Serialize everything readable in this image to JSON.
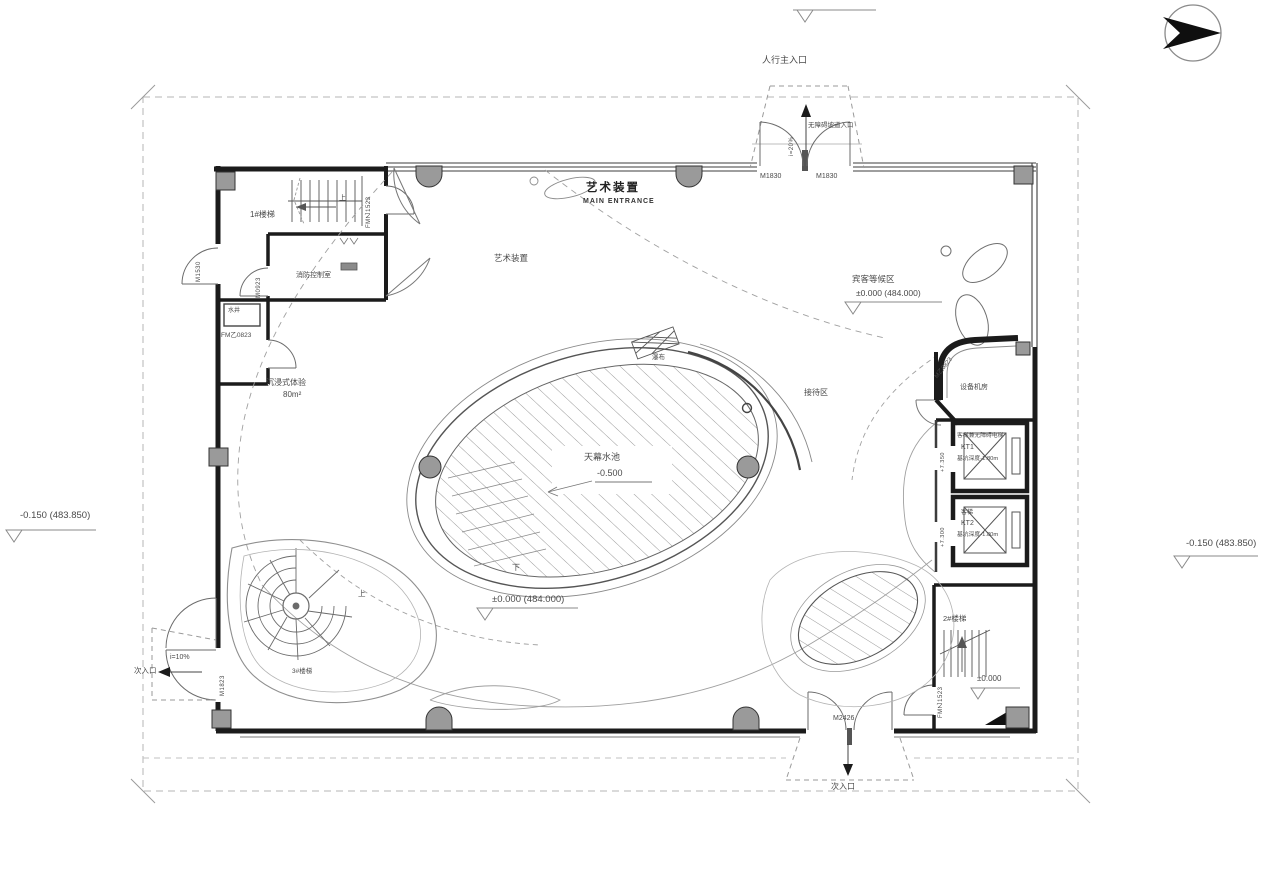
{
  "colors": {
    "wall": "#1b1b1b",
    "line_dark": "#3f3f3f",
    "line_mid": "#7a7a7a",
    "line_light": "#a9a9a9",
    "column_fill": "#9a9a9a",
    "text": "#4a4a4a"
  },
  "site": {
    "elev_left": "-0.150 (483.850)",
    "elev_right": "-0.150 (483.850)",
    "elev_floor": "±0.000 (484.000)"
  },
  "entrances": {
    "main": {
      "label": "人行主入口",
      "ramp_note": "无障碍坡道入口",
      "slope": "i=20%",
      "door_left": "M1830",
      "door_right": "M1830",
      "feature": "艺术装置",
      "feature_en": "MAIN ENTRANCE"
    },
    "left": {
      "label": "次入口",
      "slope": "i=10%",
      "door": "M1823"
    },
    "bottom": {
      "label": "次入口",
      "door": "M2426"
    }
  },
  "rooms": {
    "stair1": {
      "name": "1#楼梯",
      "up": "上",
      "door": "FM乙1523"
    },
    "stair2": {
      "name": "2#楼梯",
      "elev": "±0.000",
      "door": "FM乙1523"
    },
    "stair3": {
      "name": "3#楼梯",
      "up": "上"
    },
    "fire_control": {
      "name": "消防控制室",
      "door": "M0923"
    },
    "shaft": {
      "name": "水井",
      "door": "FM乙0823"
    },
    "exterior_door_left": "M1530",
    "immersive": {
      "name": "沉浸式体验",
      "area": "80m²"
    },
    "art_installation": "艺术装置",
    "waterfall": "瀑布",
    "pool": {
      "name": "天幕水池",
      "elev": "-0.500",
      "down": "下"
    },
    "guest_waiting": {
      "name": "宾客等候区",
      "elev": "±0.000 (484.000)"
    },
    "reception": "接待区",
    "equipment": {
      "name": "设备机房",
      "door": "M乙0823"
    }
  },
  "elevators": {
    "kt1": {
      "line1": "客梯兼无障碍电梯",
      "line2": "KT1",
      "line3": "基坑深度-1.80m",
      "dim": "+7.350"
    },
    "kt2": {
      "line1": "客梯",
      "line2": "KT2",
      "line3": "基坑深度-1.80m",
      "dim": "+7.300"
    }
  }
}
